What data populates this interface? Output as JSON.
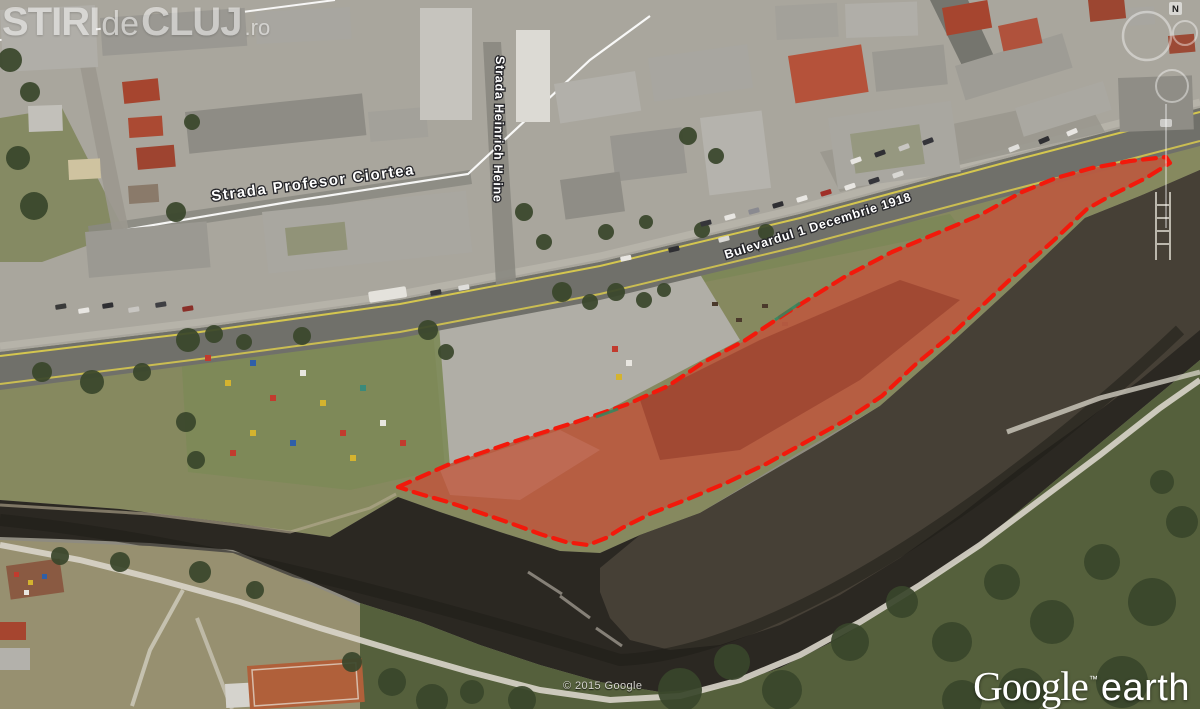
{
  "watermark": {
    "word1": "STIRI",
    "word2": "de",
    "word3": "CLUJ",
    "suffix": ".ro"
  },
  "street_labels": {
    "ciortea": "Strada Profesor Ciortea",
    "heine": "Strada Heinrich Heine",
    "bulevardul": "Bulevardul 1 Decembrie 1918"
  },
  "attribution": {
    "copyright": "© 2015 Google"
  },
  "logo": {
    "brand": "Google",
    "tm": "™",
    "product": "earth"
  },
  "navigation": {
    "north_label": "N"
  },
  "overlay": {
    "points": "398,487 452,463 516,441 576,422 628,404 668,386 704,362 744,341 788,312 846,276 892,252 940,232 980,215 1022,192 1056,178 1092,168 1130,161 1166,157 1170,163 1146,178 1110,196 1087,209 1052,242 1018,272 984,304 950,336 916,364 882,396 846,420 806,442 766,464 726,483 688,499 652,513 622,528 606,538 588,545 566,542 540,534 510,523 478,512 448,502 420,494",
    "stroke_color": "#f2190b",
    "fill_color": "rgba(195,28,16,0.42)",
    "accent_color": "#2e8a62"
  },
  "colors": {
    "road_edge_line": "#d9ca4e",
    "river_water": "#2b2822"
  }
}
